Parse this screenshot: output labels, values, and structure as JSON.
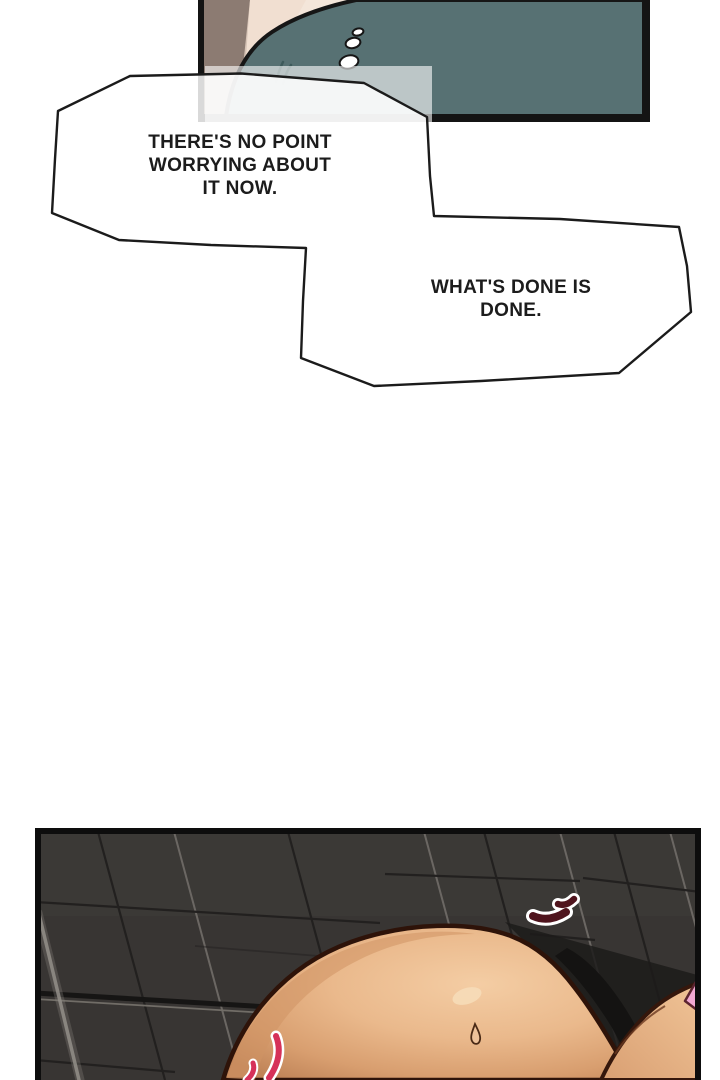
{
  "comic": {
    "bubbles": [
      {
        "lines": [
          "THERE'S NO POINT",
          "WORRYING ABOUT",
          "IT NOW."
        ]
      },
      {
        "lines": [
          "WHAT'S DONE IS",
          "DONE."
        ]
      }
    ],
    "colors": {
      "shirt_teal": "#577173",
      "wall_taupe": "#8c7b72",
      "pillow_cream": "#f4e6da",
      "skin_light": "#f2c89d",
      "skin_shadow": "#bd8156",
      "pink_strap": "#f2a9d3",
      "alert_mark_maroon": "#4f141d",
      "emphasis_mark_pink": "#d63159",
      "tile_wall": "#383533",
      "ink": "#161616"
    }
  }
}
